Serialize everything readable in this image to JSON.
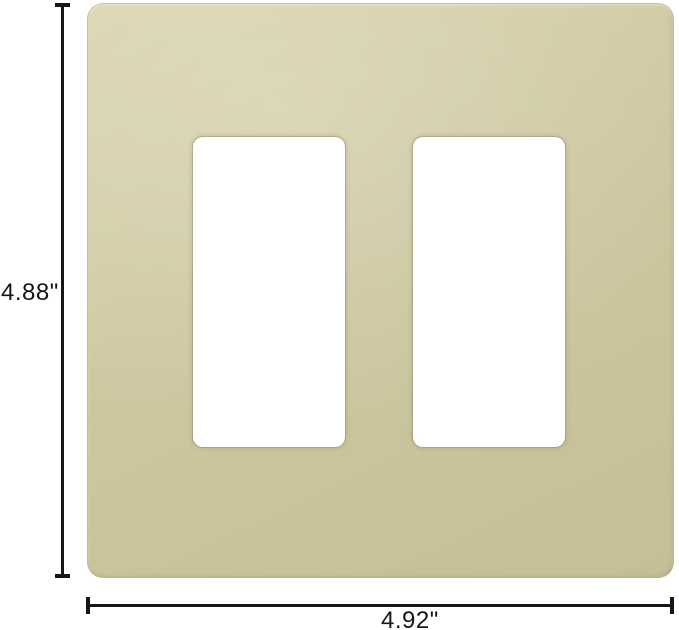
{
  "diagram": {
    "title": "Two-gang screwless decorator wall plate with dimension callouts",
    "opening_count": 2
  },
  "dimensions": {
    "height_label": "4.88\"",
    "width_label": "4.92\""
  },
  "colors": {
    "plate": "#cdc7a0",
    "plate_highlight": "#d9d3ad",
    "plate_shadow": "#c5bf97",
    "opening": "#ffffff",
    "annotation": "#161616",
    "background": "#ffffff"
  }
}
